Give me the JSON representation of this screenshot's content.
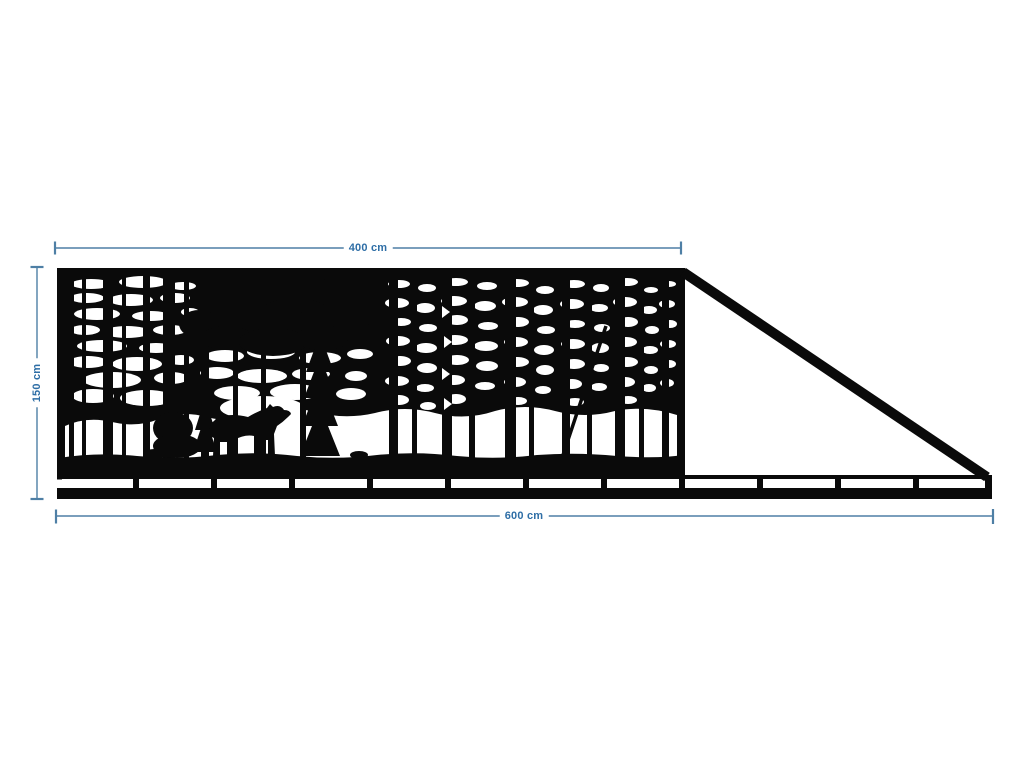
{
  "drawing": {
    "type": "sliding-gate-technical-drawing",
    "dimensions": {
      "panel_width": {
        "label": "400 cm",
        "value": 400,
        "unit": "cm"
      },
      "gate_height": {
        "label": "150 cm",
        "value": 150,
        "unit": "cm"
      },
      "total_width": {
        "label": "600 cm",
        "value": 600,
        "unit": "cm"
      }
    },
    "colors": {
      "silhouette": "#0a0a0a",
      "background": "#ffffff",
      "dimension_line": "#4e7fa5",
      "dimension_text": "#2e6ea6"
    },
    "scene": {
      "motif": "laser-cut forest panel with pine trees and a bear",
      "parts": [
        "forest-panel",
        "bear-silhouette",
        "pine-trees",
        "slotted-bottom-rail",
        "diagonal-tail-brace"
      ]
    }
  }
}
